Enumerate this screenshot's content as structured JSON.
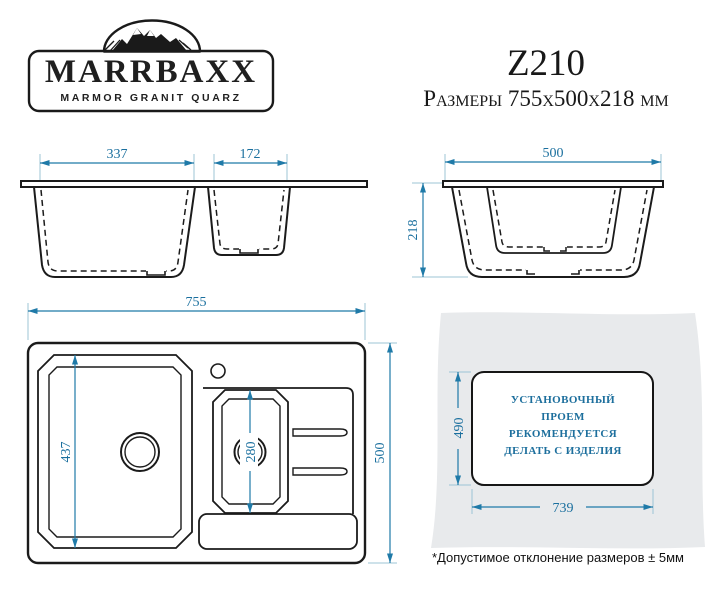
{
  "brand": {
    "name": "MARRBAXX",
    "tagline": "MARMOR GRANIT QUARZ"
  },
  "header": {
    "model": "Z210",
    "subtitle": "Размеры 755х500х218 мм"
  },
  "views": {
    "front": {
      "bowl_main_width": "337",
      "bowl_small_width": "172"
    },
    "side": {
      "width": "500",
      "height": "218"
    },
    "top": {
      "width": "755",
      "height": "500",
      "bowl_main_length": "437",
      "bowl_small_length": "280"
    },
    "cutout": {
      "height": "490",
      "width": "739",
      "note_lines": [
        "УСТАНОВОЧНЫЙ",
        "ПРОЕМ",
        "РЕКОМЕНДУЕТСЯ",
        "ДЕЛАТЬ С ИЗДЕЛИЯ"
      ]
    }
  },
  "footer": {
    "tolerance_note": "*Допустимое отклонение размеров ± 5мм"
  },
  "colors": {
    "drawing_line": "#1b1b1b",
    "dimension_line": "#1f7aa8",
    "extension_line": "#9cc4d6",
    "dimension_text": "#1a6f9e",
    "install_text": "#1d6f9d",
    "countertop_grey": "#e8eaec"
  }
}
